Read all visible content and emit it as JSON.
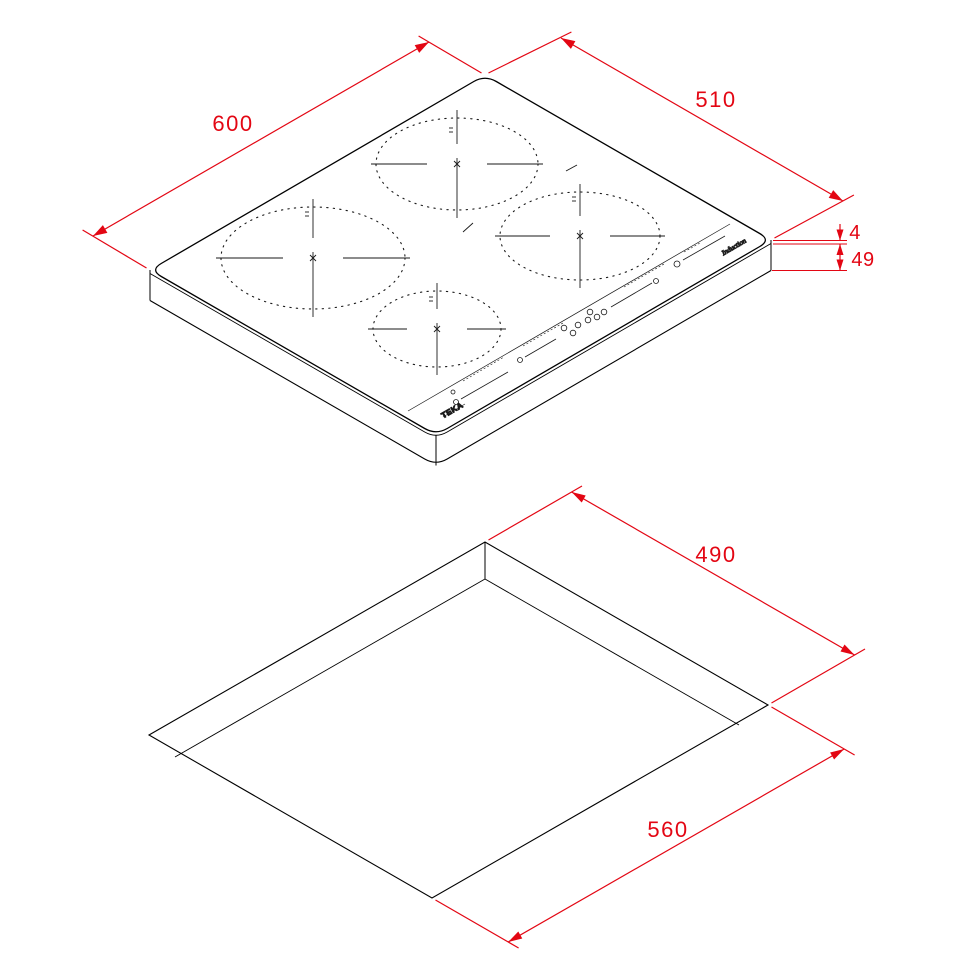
{
  "document": {
    "type": "appliance installation drawing",
    "views": [
      "induction hob isometric view",
      "worktop cutout isometric view"
    ]
  },
  "colors": {
    "dimension_red": "#e30613",
    "drawing_black": "#000000",
    "background": "#ffffff"
  },
  "top_view": {
    "description": "induction hob with 4 cooking zones and front control panel",
    "dim_width": "600",
    "dim_depth": "510",
    "dim_glass": "4",
    "dim_height": "49",
    "brand": "TEKA",
    "series_label": "Induction",
    "cooking_zones_count": 4
  },
  "bottom_view": {
    "description": "worktop cutout",
    "dim_cutout_depth": "490",
    "dim_cutout_width": "560"
  }
}
